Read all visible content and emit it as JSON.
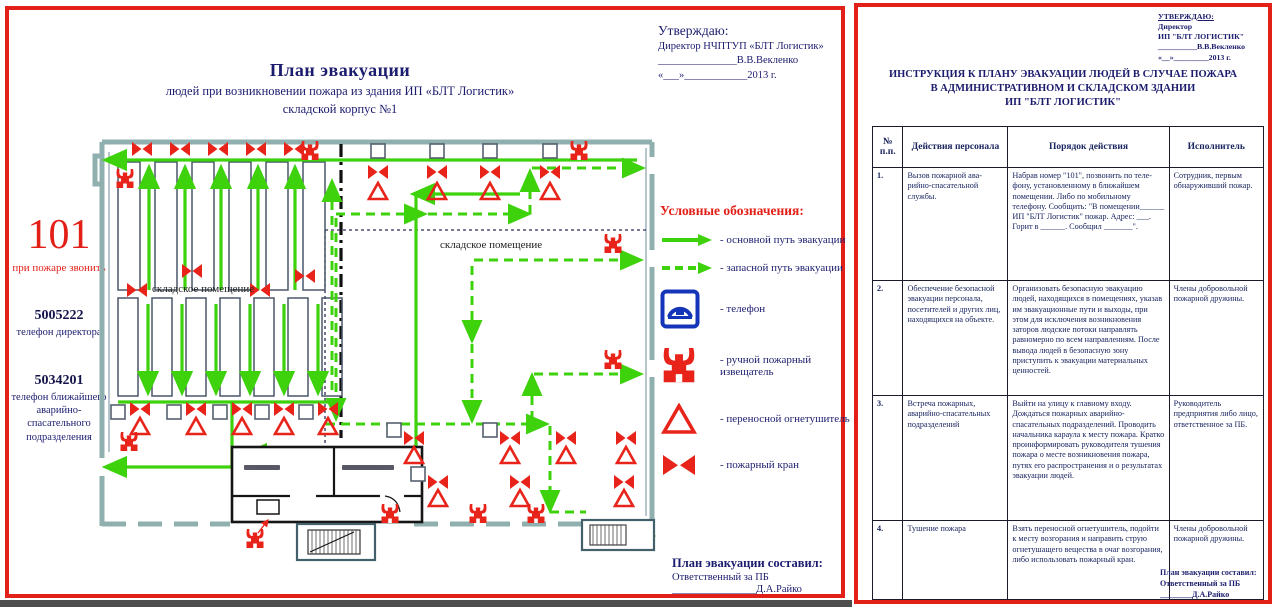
{
  "colors": {
    "accent_red": "#e32018",
    "text_navy": "#1c1c6e",
    "route_green": "#3ed20c",
    "symbol_red": "#e8231a",
    "phone_blue": "#1535b8"
  },
  "left_panel": {
    "title": "План эвакуации",
    "subtitle1": "людей при возникновении пожара из здания ИП «БЛТ Логистик»",
    "subtitle2": "складской корпус №1",
    "approve": {
      "line1": "Утверждаю:",
      "line2": "Директор НЧПТУП «БЛТ Логистик»",
      "line3": "_______________В.В.Векленко",
      "line4": "«___»____________2013 г."
    },
    "emergency": {
      "number": "101",
      "label": "при пожаре звонить",
      "phone1": "5005222",
      "phone1_label": "телефон директора",
      "phone2": "5034201",
      "phone2_label": "телефон ближайшего аварийно-спасательного подразделения"
    },
    "plan": {
      "label_left": "складское помещение",
      "label_right": "складское помещение"
    },
    "legend": {
      "title": "Условные обозначения:",
      "items": [
        {
          "icon": "solid-route-arrow",
          "label": "- основной путь эвакуации"
        },
        {
          "icon": "dashed-route-arrow",
          "label": "- запасной путь эвакуации"
        },
        {
          "icon": "phone",
          "label": "- телефон"
        },
        {
          "icon": "manual-call-point",
          "label": "- ручной пожарный извещатель"
        },
        {
          "icon": "extinguisher",
          "label": "- переносной огнетушитель"
        },
        {
          "icon": "fire-hydrant",
          "label": "- пожарный кран"
        }
      ]
    },
    "footer": {
      "line1": "План эвакуации составил:",
      "line2": "Ответственный за ПБ",
      "line3": "________________Д.А.Райко"
    }
  },
  "right_panel": {
    "approve": {
      "line1": "УТВЕРЖДАЮ:",
      "line2": "Директор",
      "line3": "ИП \"БЛТ ЛОГИСТИК\"",
      "line4": "__________В.В.Векленко",
      "line5": "«__»_________2013 г."
    },
    "title_lines": [
      "ИНСТРУКЦИЯ К ПЛАНУ ЭВАКУАЦИИ ЛЮДЕЙ В СЛУЧАЕ ПОЖАРА",
      "В АДМИНИСТРАТИВНОМ И СКЛАДСКОМ ЗДАНИИ",
      "ИП \"БЛТ ЛОГИСТИК\""
    ],
    "table": {
      "headers": [
        "№ п.п.",
        "Действия персонала",
        "Порядок действия",
        "Исполнитель"
      ],
      "rows": [
        {
          "num": "1.",
          "action": "Вызов пожарной ава-рийно-спасательной службы.",
          "procedure": "Набрав номер \"101\", позвонить по теле-фону, установленному в ближайшем помещении. Либо по мобильному телефону. Сообщить: \"В помещении______ ИП \"БЛТ Логистик\" пожар. Адрес: ___. Горит в ______. Сообщил _______\".",
          "executor": "Сотрудник, первым обнаруживший пожар."
        },
        {
          "num": "2.",
          "action": "Обеспечение безопасной эвакуации персонала, посетителей и других лиц, находящихся на объекте.",
          "procedure": "Организовать безопасную эвакуацию людей, находящихся в помещениях, указав им эвакуационные пути и выходы, при этом для исключения возникновения заторов людские потоки направлять равномерно по всем направлениям. После вывода людей в безопасную зону приступить к эвакуации материальных ценностей.",
          "executor": "Члены добровольной пожарной дружины."
        },
        {
          "num": "3.",
          "action": "Встреча пожарных, аварийно-спасательных подразделений",
          "procedure": "Выйти на улицу к главному входу. Дождаться пожарных аварийно-спасательных подразделений. Проводить начальника караула к месту пожара. Кратко проинформировать руководителя тушения пожара о месте возникновения пожара, путях его распространения и о результатах эвакуации людей.",
          "executor": "Руководитель предприятия либо лицо, ответственное за ПБ."
        },
        {
          "num": "4.",
          "action": "Тушение пожара",
          "procedure": "Взять переносной огнетушитель, подойти к месту возгорания и направить струю огнетушащего вещества в очаг возгорания, либо использовать пожарный кран.",
          "executor": "Члены добровольной пожарной дружины."
        }
      ]
    },
    "footer": {
      "line1": "План эвакуации составил:",
      "line2": "Ответственный за ПБ",
      "line3": "________Д.А.Райко"
    }
  }
}
